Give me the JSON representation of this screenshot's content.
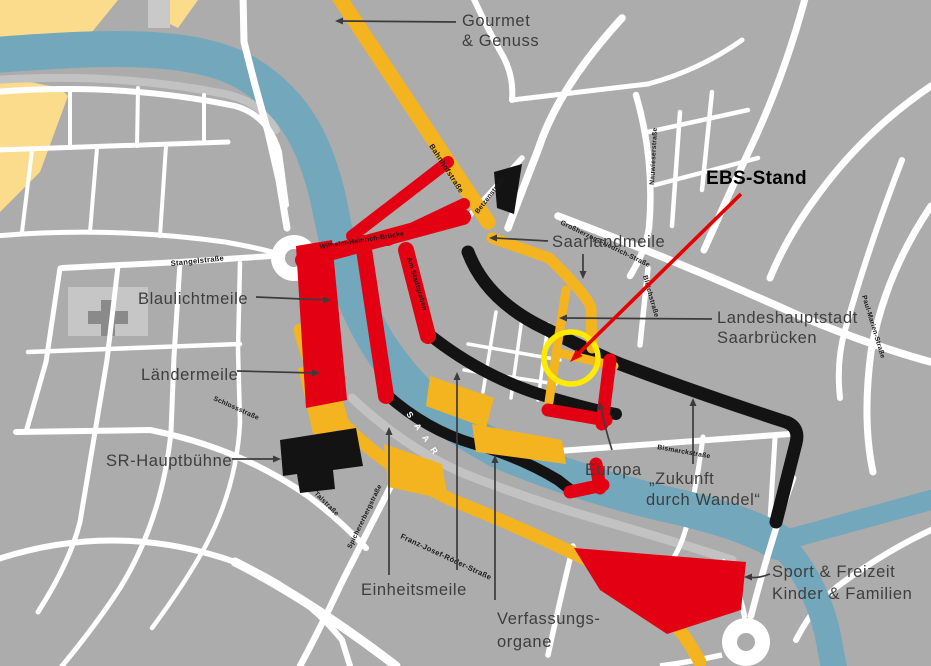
{
  "title": "Festmeilen-Karte Saarbrücken",
  "colors": {
    "background": "#ACACAC",
    "street": "#FFFFFF",
    "river": "#73A7BC",
    "park": "#FBDC8C",
    "route_amber": "#F4B41F",
    "route_red": "#E30013",
    "route_black": "#131313",
    "highlight_circle": "#FFEA00",
    "ebs_arrow": "#E60000",
    "label": "#3E3E3E"
  },
  "river": {
    "name": "S A A R"
  },
  "zones": {
    "gourmet_line1": "Gourmet",
    "gourmet_line2": "& Genuss",
    "saarlandmeile": "Saarlandmeile",
    "landeshauptstadt_line1": "Landeshauptstadt",
    "landeshauptstadt_line2": "Saarbrücken",
    "blaulichtmeile": "Blaulichtmeile",
    "laendermeile": "Ländermeile",
    "sr_hauptbuehne": "SR-Hauptbühne",
    "europa": "Europa",
    "zukunft_line1": "„Zukunft",
    "zukunft_line2": "durch Wandel“",
    "einheitsmeile": "Einheitsmeile",
    "verfassungsorgane_line1": "Verfassungs-",
    "verfassungsorgane_line2": "organe",
    "sport_line1": "Sport & Freizeit",
    "sport_line2": "Kinder & Familien",
    "ebs_stand": "EBS-Stand"
  },
  "streets": {
    "stangelstrasse": "Stangelstraße",
    "wilhelm_heinrich_bruecke": "Wilhelm-Heinrich-Brücke",
    "am_stadtgraben": "Am Stadtgraben",
    "bahnhofstrasse": "Bahnhofstraße",
    "betzenstrasse": "Betzenstraße",
    "nauwieserstrasse": "Nauwieserstraße",
    "grossherzog_friedrich_strasse": "Großherzog-Friedrich-Straße",
    "bleichstrasse": "Bleichstraße",
    "paul_marien_strasse": "Paul-Marien-Straße",
    "bismarckstrasse": "Bismarckstraße",
    "franz_josef_roeder_strasse": "Franz-Josef-Röder-Straße",
    "schlossstrasse": "Schlossstraße",
    "talstrasse": "Talstraße",
    "spichererbergstrasse": "Spichererbergstraße"
  }
}
